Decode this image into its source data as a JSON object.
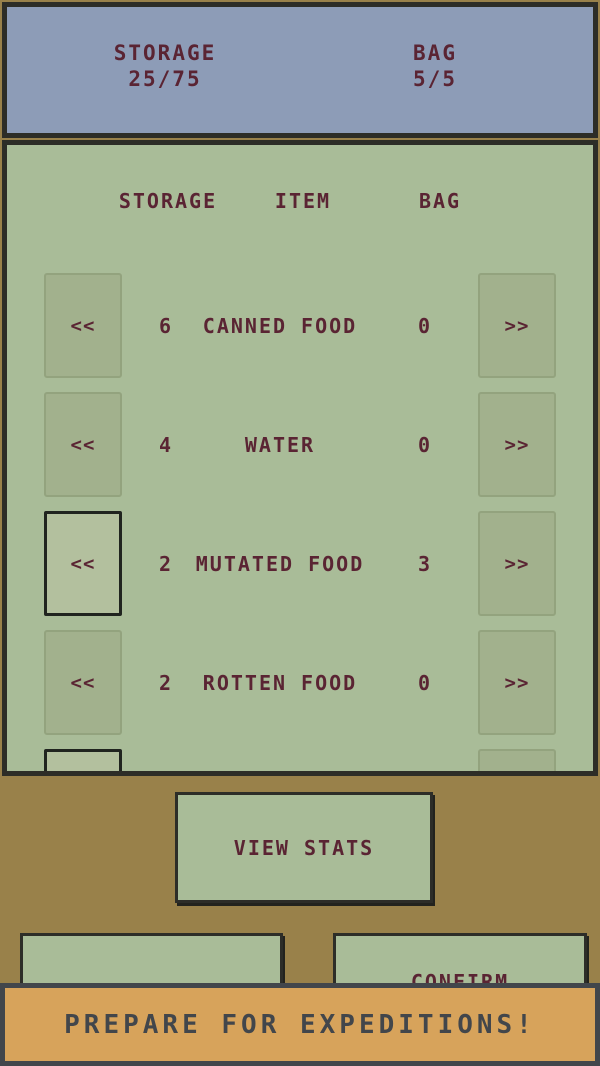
{
  "header": {
    "storage_label": "STORAGE",
    "storage_value": "25/75",
    "bag_label": "BAG",
    "bag_value": "5/5"
  },
  "table": {
    "columns": {
      "storage": "STORAGE",
      "item": "ITEM",
      "bag": "BAG"
    },
    "move_to_storage_label": "<<",
    "move_to_bag_label": ">>",
    "rows": [
      {
        "storage": "6",
        "item": "CANNED FOOD",
        "bag": "0"
      },
      {
        "storage": "4",
        "item": "WATER",
        "bag": "0"
      },
      {
        "storage": "2",
        "item": "MUTATED FOOD",
        "bag": "3"
      },
      {
        "storage": "2",
        "item": "ROTTEN FOOD",
        "bag": "0"
      },
      {
        "storage": "",
        "item": "",
        "bag": ""
      }
    ]
  },
  "buttons": {
    "view_stats": "VIEW STATS",
    "confirm": "CONFIRM"
  },
  "banner": {
    "text": "PREPARE FOR EXPEDITIONS!"
  },
  "colors": {
    "background_brown": "#99814a",
    "header_blue": "#8d9cb7",
    "panel_green": "#a9bc98",
    "button_green": "#a2b18d",
    "text_maroon": "#5a2433",
    "border_dark": "#2d2d27",
    "banner_orange": "#d7a35b",
    "banner_dark": "#42464b"
  }
}
